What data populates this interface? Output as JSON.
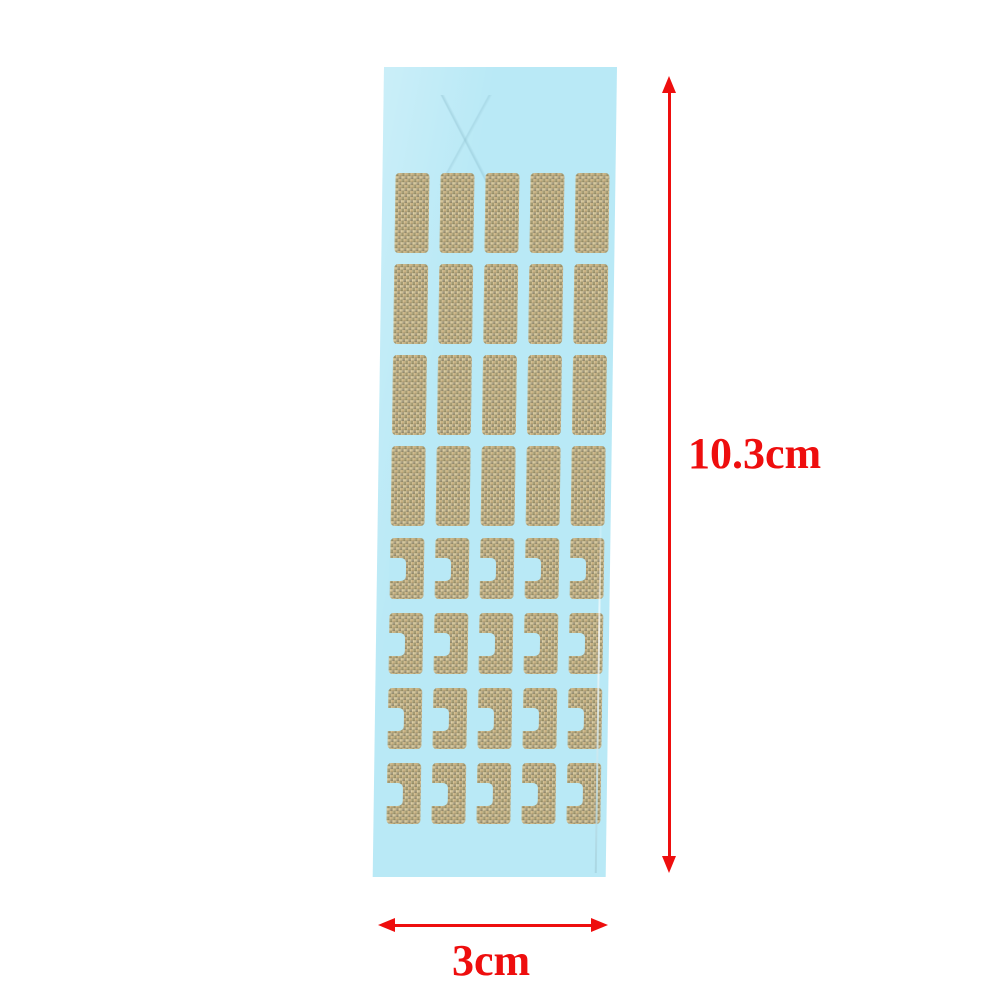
{
  "colors": {
    "accent": "#ee0e0e",
    "sheet": "#b9e9f6",
    "page_bg": "#ffffff"
  },
  "annotations": {
    "height_label": "10.3cm",
    "width_label": "3cm"
  },
  "sheet": {
    "columns": 5,
    "rows": [
      {
        "type": "rect"
      },
      {
        "type": "rect"
      },
      {
        "type": "rect"
      },
      {
        "type": "rect"
      },
      {
        "type": "notched"
      },
      {
        "type": "notched"
      },
      {
        "type": "notched"
      },
      {
        "type": "notched"
      }
    ],
    "sticker_base_color": "#b3a37c"
  }
}
